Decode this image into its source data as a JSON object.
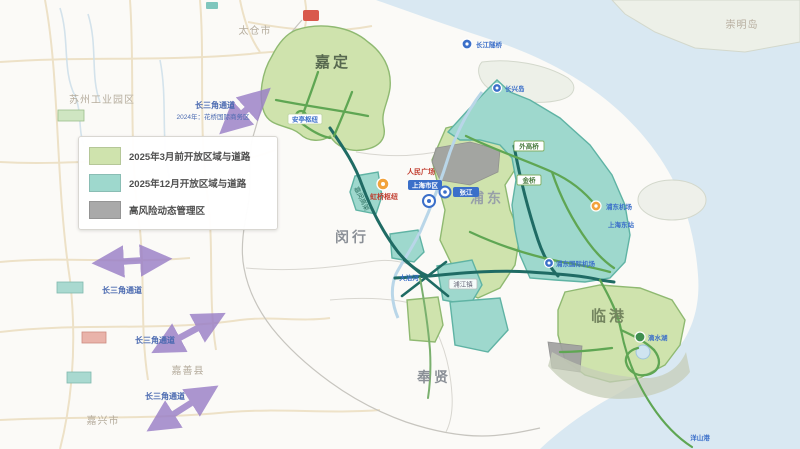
{
  "legend": {
    "items": [
      {
        "label": "2025年3月前开放区域与道路",
        "color": "#cfe3ad"
      },
      {
        "label": "2025年12月开放区域与道路",
        "color": "#9ed8cd"
      },
      {
        "label": "高风险动态管理区",
        "color": "#a9a9a9"
      }
    ]
  },
  "regions": {
    "jiading": "嘉定",
    "minhang": "闵行",
    "pudong": "浦东",
    "lingang": "临港",
    "fengxian": "奉贤"
  },
  "neighbors": {
    "suzhou": "苏州工业园区",
    "taicang": "太仓市",
    "jiaxing": "嘉兴市",
    "jiashan": "嘉善县",
    "chongming": "崇明岛"
  },
  "corridor": {
    "label": "长三角通道",
    "note": "2024年：花桥国际商务区"
  },
  "landmarks": {
    "anting": "安亭枢纽",
    "hongqiao": "虹桥枢纽",
    "renmin": "人民广场",
    "downtown": "上海市区",
    "zhangjiang": "张江",
    "waigaoqiao": "外高桥",
    "jinqiao": "金桥",
    "pujiang": "浦江镇",
    "dazhihe": "大治河",
    "pvg": "浦东机场",
    "east_station": "上海东站",
    "pvg_full": "浦东国际机场",
    "dishui": "滴水湖",
    "yangshan": "洋山港",
    "tunnel": "长江隧桥",
    "changxing": "长兴岛",
    "jiamin_road": "嘉闵高架"
  },
  "colors": {
    "open_march_area": "#cfe3ad",
    "open_december_area": "#9ed8cd",
    "high_risk_area": "#a9a9a9",
    "corridor_arrow": "#9a7fc7",
    "water": "#d9e8f2",
    "road_main": "#1f6b64",
    "road_open": "#5fa653"
  }
}
